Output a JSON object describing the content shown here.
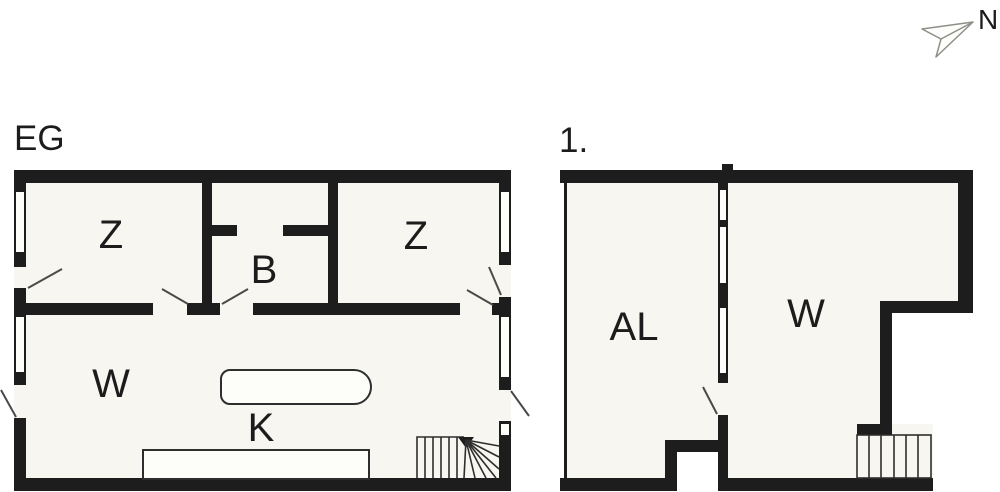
{
  "compass": {
    "label": "N"
  },
  "colors": {
    "wall": "#1d1d1d",
    "room-fill": "#f7f6f0",
    "window-fill": "#fdfdfa",
    "line": "#2e2e2e",
    "swing": "#4a4a4a",
    "arrow-stroke": "#8f8f88",
    "text": "#1c1c1c"
  },
  "plans": [
    {
      "title": "EG",
      "rooms": [
        {
          "label": "Z"
        },
        {
          "label": "B"
        },
        {
          "label": "Z"
        },
        {
          "label": "W"
        },
        {
          "label": "K"
        }
      ]
    },
    {
      "title": "1.",
      "rooms": [
        {
          "label": "AL"
        },
        {
          "label": "W"
        }
      ]
    }
  ]
}
